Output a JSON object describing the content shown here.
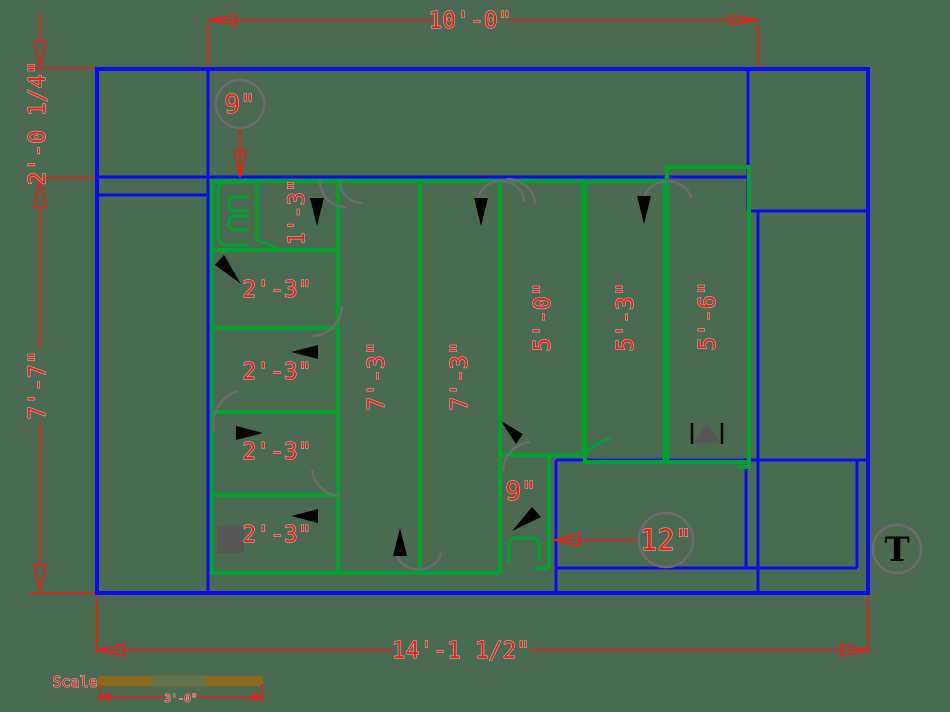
{
  "drawing": {
    "background": "#4a6b51",
    "colors": {
      "wall_blue": "#0b0bf2",
      "partition_green": "#00a32e",
      "dimension_red": "#f21b15",
      "annotation_gray": "#6f6a70",
      "symbol_gray": "#575757",
      "scale_brown": "#8a691c"
    },
    "dims": {
      "top": "10'-0\"",
      "left_upper": "2'-0 1/4\"",
      "left_overall": "7'-7\"",
      "bottom": "14'-1 1/2\"",
      "callout_top_offset": "9\"",
      "inline_offset": "9\"",
      "callout_right_offset": "12\""
    },
    "rooms": [
      {
        "label": "1'-3\""
      },
      {
        "label": "2'-3\""
      },
      {
        "label": "2'-3\""
      },
      {
        "label": "2'-3\""
      },
      {
        "label": "2'-3\""
      },
      {
        "label": "7'-3\""
      },
      {
        "label": "7'-3\""
      },
      {
        "label": "5'-0\""
      },
      {
        "label": "5'-3\""
      },
      {
        "label": "5'-6\""
      }
    ],
    "scale_bar": {
      "label": "Scale",
      "value": "3'-0\""
    },
    "symbols": {
      "thermostat_tag": "T"
    }
  }
}
